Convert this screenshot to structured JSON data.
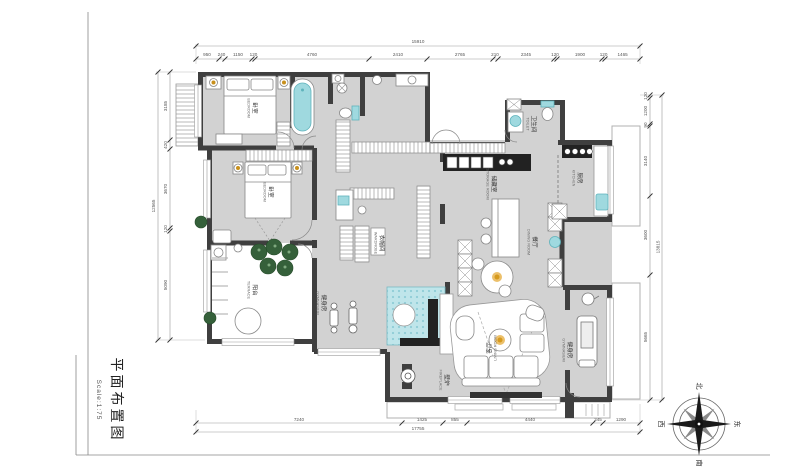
{
  "title_block": {
    "title": "平面布置图",
    "scale": "Scale:1:75"
  },
  "rooms": {
    "bedroom1": {
      "zh": "卧室",
      "en": "BEDROOM"
    },
    "bedroom2": {
      "zh": "卧室",
      "en": "BEDROOM"
    },
    "toilet": {
      "zh": "卫生间",
      "en": "TOILET"
    },
    "kitchen": {
      "zh": "厨房",
      "en": "KITCHEN"
    },
    "storage": {
      "zh": "储藏室",
      "en": "STORAGE ROOM"
    },
    "dining": {
      "zh": "餐厅",
      "en": "DINING ROOM"
    },
    "wardrobe": {
      "zh": "衣帽间",
      "en": "WARDROBE"
    },
    "terrace": {
      "zh": "阳台",
      "en": "TERRACE"
    },
    "gym_center": {
      "zh": "健身房",
      "en": "GYMNASIUM"
    },
    "gym_right": {
      "zh": "健身房",
      "en": "GYMNASIUM"
    },
    "living": {
      "zh": "客厅",
      "en": "LIVING ROOM"
    },
    "fireplace": {
      "zh": "壁炉",
      "en": "FIREPLACE"
    }
  },
  "dimensions": {
    "top": {
      "total": "15910",
      "segments": [
        "950",
        "240",
        "1150",
        "120",
        "4760",
        "2410",
        "2765",
        "210",
        "2345",
        "120",
        "1900",
        "120",
        "1465"
      ]
    },
    "bottom": {
      "total": "17755",
      "segments": [
        "7240",
        "1425",
        "855",
        "4440",
        "345",
        "1290"
      ]
    },
    "left": {
      "total": "12565",
      "segments": [
        "3185",
        "420",
        "3670",
        "120",
        "5090"
      ]
    },
    "right": {
      "total": "13815",
      "segments": [
        "120",
        "1200",
        "90",
        "3140",
        "3600",
        "5665"
      ]
    }
  },
  "compass": {
    "n": "北",
    "s": "南",
    "e": "东",
    "w": "西"
  },
  "colors": {
    "floor": "#d2d2d2",
    "wall": "#3f3f3f",
    "teal": "#9fd9df",
    "rug": "#bfe5ea",
    "plant": "#35603a",
    "lamp": "#d59a1e"
  }
}
